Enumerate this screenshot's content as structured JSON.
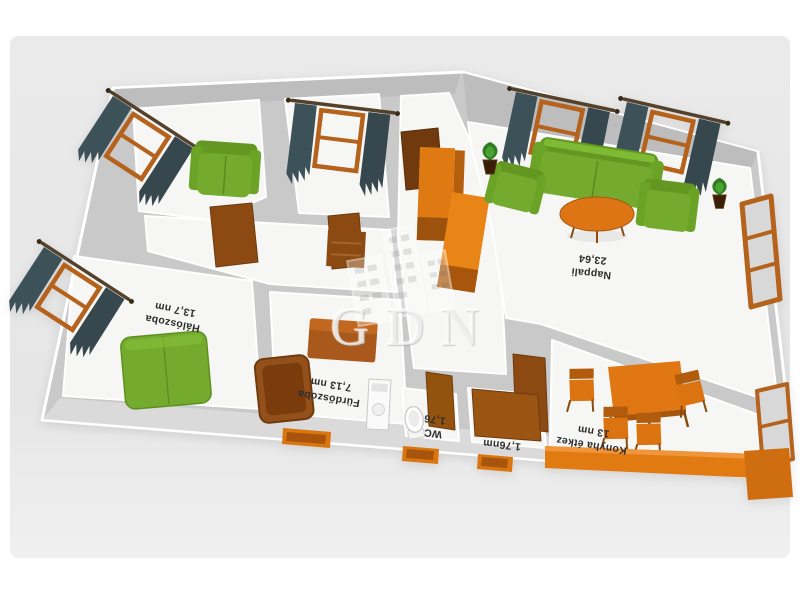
{
  "image": {
    "type": "3d-floorplan-render",
    "background": "#e9e9e9",
    "watermark": {
      "letters": "GDN"
    }
  },
  "palette": {
    "wall_face": "#c9c9c9",
    "floor": "#f6f6f4",
    "green_furniture": "#74ab2e",
    "green_dark": "#639722",
    "orange_furniture": "#e07714",
    "wood_brown": "#8c4a12",
    "curtain_dark": "#3d5159",
    "window_frame": "#b4621c"
  },
  "rooms": [
    {
      "id": "nappali",
      "name": "Nappali",
      "area": "23,64"
    },
    {
      "id": "haloszoba",
      "name": "Hálószoba",
      "area": "13,7 nm"
    },
    {
      "id": "furdoszoba",
      "name": "Fürdőszoba",
      "area": "7,13 nm"
    },
    {
      "id": "wc",
      "name": "WC",
      "area": "1,76"
    },
    {
      "id": "eloter",
      "name": "",
      "area": "1,76nm"
    },
    {
      "id": "konyha",
      "name": "Konyha étkez",
      "area": "13 nm"
    }
  ]
}
